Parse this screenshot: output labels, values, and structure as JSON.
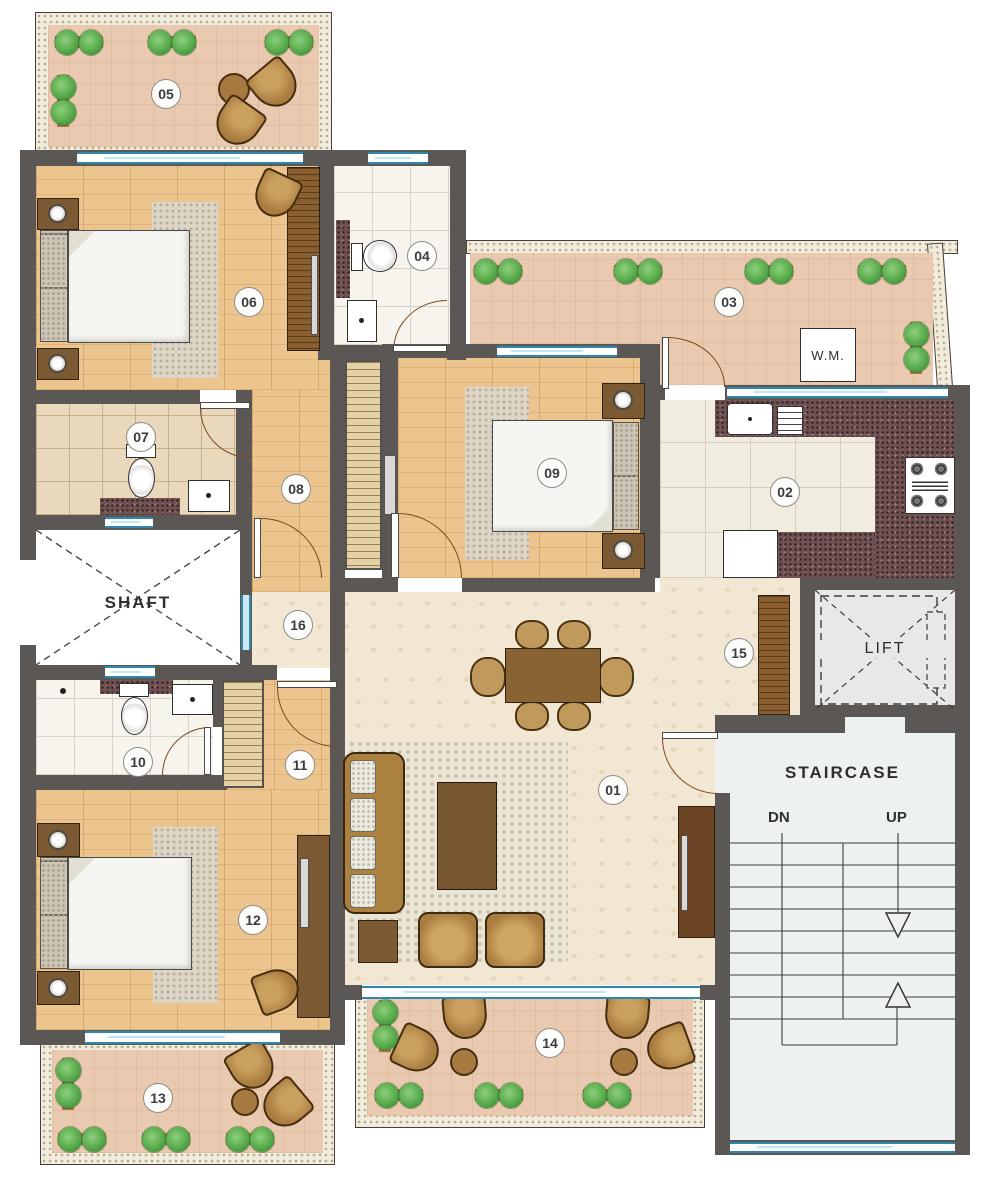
{
  "rooms": {
    "r01": "01",
    "r02": "02",
    "r03": "03",
    "r04": "04",
    "r05": "05",
    "r06": "06",
    "r07": "07",
    "r08": "08",
    "r09": "09",
    "r10": "10",
    "r11": "11",
    "r12": "12",
    "r13": "13",
    "r14": "14",
    "r15": "15",
    "r16": "16"
  },
  "texts": {
    "shaft": "SHAFT",
    "lift": "LIFT",
    "staircase": "STAIRCASE",
    "down": "DN",
    "up": "UP",
    "washing_machine": "W.M."
  },
  "colors": {
    "wall": "#5b5755",
    "window_blue": "#2e88ab",
    "wood_floor": "#ecc48e",
    "hall_floor": "#f1e7d3",
    "balcony_floor": "#e9cab0",
    "bathroom_tile": "#f7f4ee",
    "kitchen_tile": "#f1ece0",
    "granite_counter": "#6e5150",
    "stair_floor": "#eef1f2",
    "plant_green": "#57aa4b",
    "furniture_wood": "#b5863f"
  }
}
